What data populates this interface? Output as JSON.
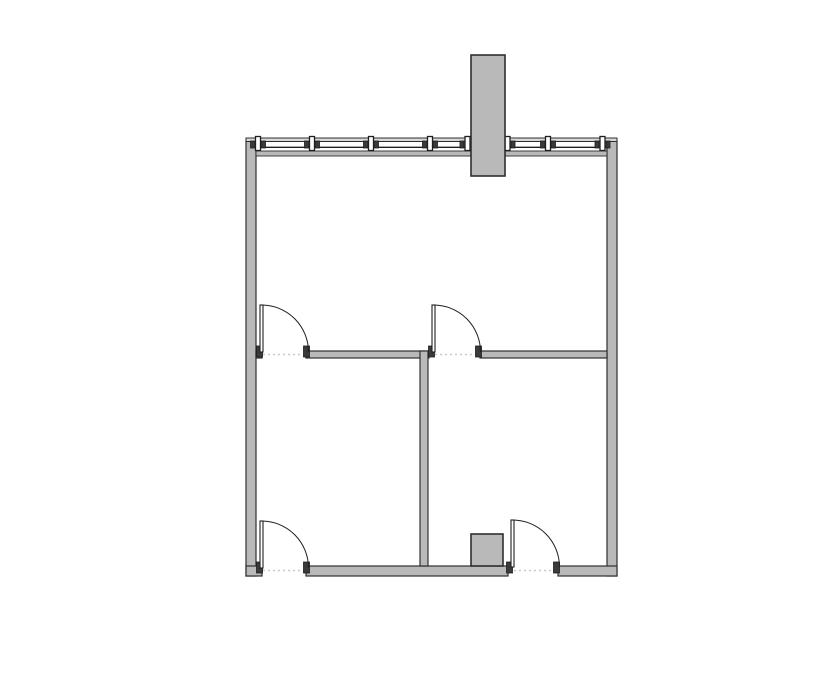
{
  "plan": {
    "canvas": {
      "width": 835,
      "height": 678
    },
    "colors": {
      "background": "#ffffff",
      "wall_fill": "#b9b9b9",
      "wall_stroke": "#2f2f2f",
      "line_dark": "#1f1f1f",
      "jamb_fill": "#3a3a3a",
      "outer_band_fill": "#d8d8d8",
      "threshold": "#c9c9c9",
      "leaf_fill": "#ffffff"
    },
    "walls": [
      {
        "id": "exterior-left-wall",
        "x": 246,
        "y": 140,
        "w": 10,
        "h": 436
      },
      {
        "id": "exterior-right-wall",
        "x": 607,
        "y": 140,
        "w": 10,
        "h": 436
      },
      {
        "id": "bottom-wall-left-stub",
        "x": 246,
        "y": 566,
        "w": 16,
        "h": 10
      },
      {
        "id": "bottom-wall-center",
        "x": 306,
        "y": 566,
        "w": 202,
        "h": 10
      },
      {
        "id": "bottom-wall-right",
        "x": 558,
        "y": 566,
        "w": 59,
        "h": 10
      },
      {
        "id": "middle-wall-left-stub",
        "x": 256,
        "y": 351,
        "w": 6,
        "h": 7
      },
      {
        "id": "middle-wall-center",
        "x": 306,
        "y": 351,
        "w": 123,
        "h": 7
      },
      {
        "id": "middle-wall-right",
        "x": 480,
        "y": 351,
        "w": 127,
        "h": 7
      },
      {
        "id": "interior-vertical-wall",
        "x": 420,
        "y": 351,
        "w": 8,
        "h": 215
      }
    ],
    "window_wall": {
      "outer_band": {
        "x": 246,
        "y": 138,
        "w": 371,
        "h": 3.5
      },
      "inner_line": {
        "x1": 256,
        "x2": 607,
        "y": 147.3
      },
      "inner_band": {
        "x": 256,
        "y": 151,
        "w": 351,
        "h": 5
      },
      "mullion_glyph": {
        "top": 136.5,
        "center_w": 5,
        "center_h": 14,
        "flange_w": 4,
        "flange_h": 7,
        "flange_y": 141
      },
      "mullions": [
        258,
        312,
        371,
        430,
        467.5,
        507.5,
        548,
        602.5
      ]
    },
    "shaft": {
      "id": "roof-shaft-column",
      "x": 471,
      "y": 55,
      "w": 34,
      "h": 121
    },
    "column_box": {
      "id": "interior-column-box",
      "x": 471,
      "y": 534,
      "w": 32,
      "h": 32
    },
    "doors": [
      {
        "id": "door-upper-left",
        "leaf": {
          "x": 260,
          "y": 305,
          "w": 3,
          "h": 47
        },
        "arc": "M 261.5 305 A 47 47 0 0 1 308.5 352",
        "jambs": [
          {
            "x": 256.5,
            "y": 346,
            "w": 6,
            "h": 11
          },
          {
            "x": 303.5,
            "y": 346,
            "w": 6,
            "h": 11
          }
        ],
        "threshold": {
          "x1": 263,
          "x2": 303,
          "y": 354.5
        }
      },
      {
        "id": "door-upper-right",
        "leaf": {
          "x": 432,
          "y": 305,
          "w": 3,
          "h": 47
        },
        "arc": "M 433.5 305 A 47 47 0 0 1 480.5 352",
        "jambs": [
          {
            "x": 428.5,
            "y": 346,
            "w": 6,
            "h": 11
          },
          {
            "x": 475.5,
            "y": 346,
            "w": 6,
            "h": 11
          }
        ],
        "threshold": {
          "x1": 435,
          "x2": 475,
          "y": 354.5
        }
      },
      {
        "id": "door-lower-left",
        "leaf": {
          "x": 260,
          "y": 521,
          "w": 3,
          "h": 47
        },
        "arc": "M 261.5 521 A 47 47 0 0 1 308.5 568",
        "jambs": [
          {
            "x": 256.5,
            "y": 562,
            "w": 6,
            "h": 11
          },
          {
            "x": 303.5,
            "y": 562,
            "w": 6,
            "h": 11
          }
        ],
        "threshold": {
          "x1": 263,
          "x2": 303,
          "y": 570.5
        }
      },
      {
        "id": "door-lower-right",
        "leaf": {
          "x": 511,
          "y": 520,
          "w": 3,
          "h": 47
        },
        "arc": "M 512.5 520 A 47 47 0 0 1 559.5 567",
        "jambs": [
          {
            "x": 506.5,
            "y": 562,
            "w": 6,
            "h": 11
          },
          {
            "x": 553.5,
            "y": 562,
            "w": 6,
            "h": 11
          }
        ],
        "threshold": {
          "x1": 514,
          "x2": 553,
          "y": 570.5
        }
      }
    ]
  }
}
